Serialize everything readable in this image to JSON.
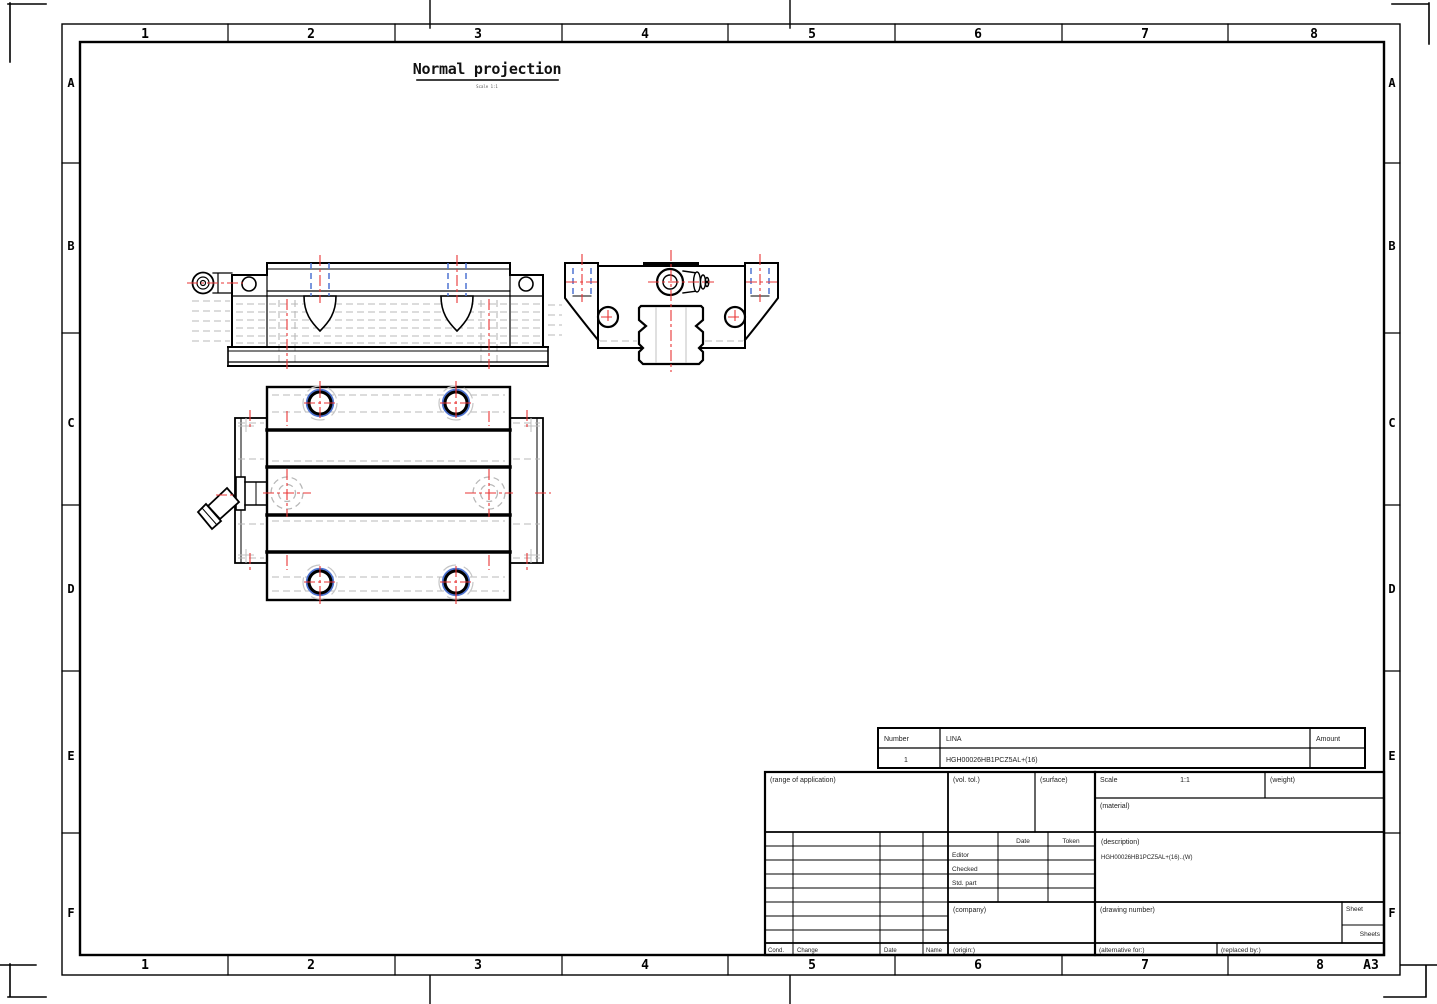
{
  "page": {
    "view_title": "Normal projection",
    "view_caption": "Scale 1:1"
  },
  "border": {
    "columns": [
      "1",
      "2",
      "3",
      "4",
      "5",
      "6",
      "7",
      "8"
    ],
    "rows": [
      "A",
      "B",
      "C",
      "D",
      "E",
      "F"
    ],
    "format": "A3"
  },
  "parts_list": {
    "col_number": "Number",
    "col_name": "LINA",
    "col_amount": "Amount",
    "row": {
      "number": "1",
      "name": "HGH00026HB1PCZ5AL+(16)",
      "amount": ""
    }
  },
  "title_block": {
    "range_of_application": "(range of application)",
    "general_tolerance": "(vol. tol.)",
    "surface": "(surface)",
    "scale_label": "Scale",
    "scale_value": "1:1",
    "weight": "(weight)",
    "material": "(material)",
    "description_label": "(description)",
    "description_value": "HGH00026HB1PCZ5AL+(16)..(W)",
    "approvals": {
      "date_header": "Date",
      "name_header": "Token",
      "rows": [
        "Editor",
        "Checked",
        "Std. part"
      ]
    },
    "company": "(company)",
    "drawing_number": "(drawing number)",
    "sheet_label": "Sheet",
    "sheets_label": "Sheets",
    "origin": "(origin:)",
    "alternative_for": "(alternative for:)",
    "replaced_by": "(replaced by:)",
    "revisions": {
      "cond": "Cond.",
      "change": "Change",
      "date": "Date",
      "name": "Name"
    }
  },
  "colors": {
    "outline": "#000000",
    "centerline": "#e93434",
    "hidden_hole": "#4f74d2",
    "hidden_detail": "#b8b8b8"
  }
}
